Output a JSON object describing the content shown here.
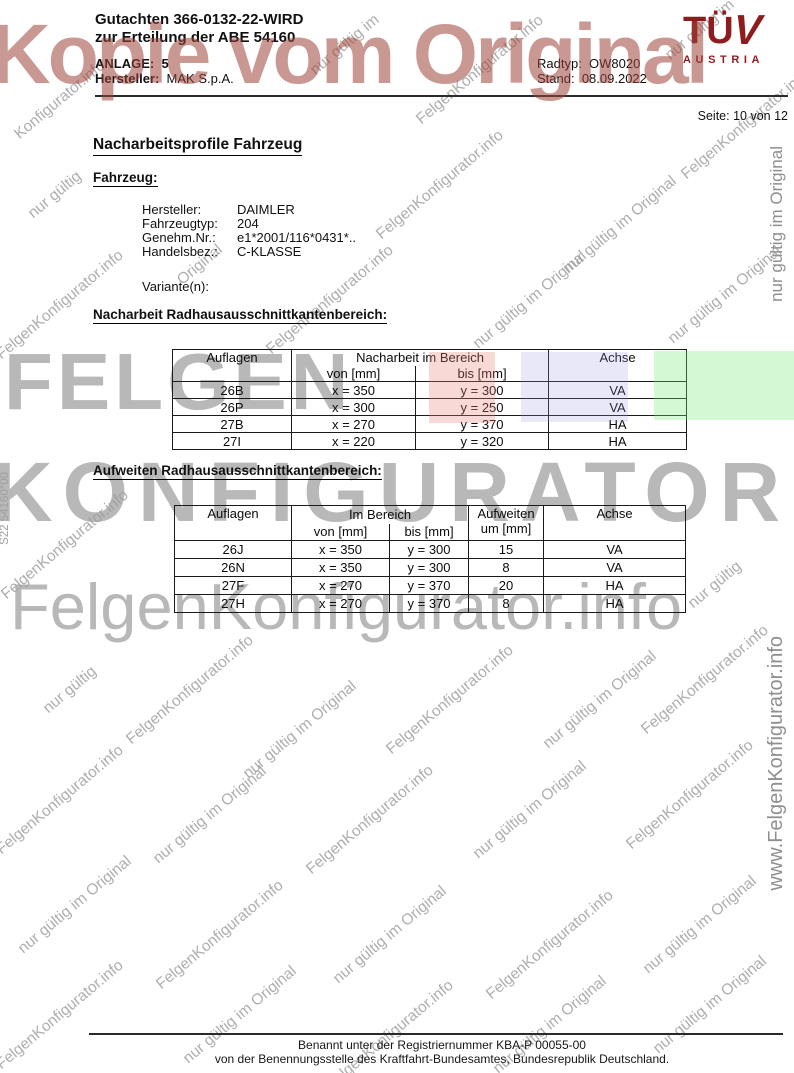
{
  "header": {
    "title_line1": "Gutachten 366-0132-22-WIRD",
    "title_line2": "zur Erteilung der ABE 54160",
    "anlage_label": "ANLAGE:",
    "anlage_value": "5",
    "hersteller_label": "Hersteller:",
    "hersteller_value": "MAK S.p.A.",
    "radtyp_label": "Radtyp:",
    "radtyp_value": "OW8020",
    "stand_label": "Stand:",
    "stand_value": "08.09.2022",
    "page_label": "Seite: 10 von 12",
    "logo": {
      "tuv_t": "T",
      "tuv_u": "Ü",
      "tuv_v": "V",
      "austria": "AUSTRIA",
      "color": "#8e1c1f"
    }
  },
  "content": {
    "main_heading": "Nacharbeitsprofile Fahrzeug",
    "vehicle_heading": "Fahrzeug:",
    "vehicle_rows": [
      {
        "label": "Hersteller:",
        "value": "DAIMLER"
      },
      {
        "label": "Fahrzeugtyp:",
        "value": "204"
      },
      {
        "label": "Genehm.Nr.:",
        "value": "e1*2001/116*0431*.."
      },
      {
        "label": "Handelsbez.:",
        "value": "C-KLASSE"
      }
    ],
    "variante_label": "Variante(n):",
    "table1": {
      "heading": "Nacharbeit Radhausausschnittkantenbereich:",
      "col_auflagen": "Auflagen",
      "col_bereich": "Nacharbeit im Bereich",
      "col_achse": "Achse",
      "sub_von": "von [mm]",
      "sub_bis": "bis [mm]",
      "rows": [
        [
          "26B",
          "x = 350",
          "y = 300",
          "VA"
        ],
        [
          "26P",
          "x = 300",
          "y = 250",
          "VA"
        ],
        [
          "27B",
          "x = 270",
          "y = 370",
          "HA"
        ],
        [
          "27I",
          "x = 220",
          "y = 320",
          "HA"
        ]
      ]
    },
    "table2": {
      "heading": "Aufweiten Radhausausschnittkantenbereich:",
      "col_auflagen": "Auflagen",
      "col_bereich": "Im Bereich",
      "col_aufweiten_l1": "Aufweiten",
      "col_aufweiten_l2": "um [mm]",
      "col_achse": "Achse",
      "sub_von": "von [mm]",
      "sub_bis": "bis [mm]",
      "rows": [
        [
          "26J",
          "x = 350",
          "y = 300",
          "15",
          "VA"
        ],
        [
          "26N",
          "x = 350",
          "y = 300",
          "8",
          "VA"
        ],
        [
          "27F",
          "x = 270",
          "y = 370",
          "20",
          "HA"
        ],
        [
          "27H",
          "x = 270",
          "y = 370",
          "8",
          "HA"
        ]
      ]
    },
    "highlights": [
      {
        "x": 429,
        "y": 352,
        "w": 66,
        "h": 71,
        "color": "rgba(236,128,118,0.30)"
      },
      {
        "x": 521,
        "y": 352,
        "w": 107,
        "h": 70,
        "color": "rgba(148,148,228,0.22)"
      },
      {
        "x": 654,
        "y": 351,
        "w": 140,
        "h": 69,
        "color": "rgba(118,232,118,0.32)"
      }
    ]
  },
  "footer": {
    "line1": "Benannt unter der Registriernummer KBA-P 00055-00",
    "line2": "von der Benennungsstelle des Kraftfahrt-Bundesamtes, Bundesrepublik Deutschland."
  },
  "watermark": {
    "kopie_text": "Kopie vom Original",
    "kopie_color": "rgba(158,68,58,0.55)",
    "big_felgen": "FELGEN",
    "big_konfigurator": "KONFIGURATOR",
    "big_info": "FelgenKonfigurator.info",
    "side_right_top": "nur gültig im Original",
    "side_right_bottom": "www.FelgenKonfigurator.info",
    "side_left": "S22 54160*00",
    "texts": [
      "nur gültig im Original",
      "FelgenKonfigurator.info",
      "Original",
      "nur gültig im",
      "Konfigurator.info",
      "nur gültig"
    ],
    "items": [
      {
        "x": 60,
        "y": 100,
        "t": 4
      },
      {
        "x": 345,
        "y": 45,
        "t": 3
      },
      {
        "x": 480,
        "y": 70,
        "t": 1
      },
      {
        "x": 700,
        "y": 30,
        "t": 3
      },
      {
        "x": 55,
        "y": 195,
        "t": 5
      },
      {
        "x": 200,
        "y": 265,
        "t": 2
      },
      {
        "x": 440,
        "y": 185,
        "t": 1
      },
      {
        "x": 620,
        "y": 225,
        "t": 0
      },
      {
        "x": 745,
        "y": 125,
        "t": 1
      },
      {
        "x": 60,
        "y": 305,
        "t": 1
      },
      {
        "x": 330,
        "y": 300,
        "t": 1
      },
      {
        "x": 530,
        "y": 300,
        "t": 0
      },
      {
        "x": 725,
        "y": 295,
        "t": 0
      },
      {
        "x": 65,
        "y": 545,
        "t": 1
      },
      {
        "x": 715,
        "y": 585,
        "t": 5
      },
      {
        "x": 70,
        "y": 690,
        "t": 5
      },
      {
        "x": 190,
        "y": 690,
        "t": 1
      },
      {
        "x": 300,
        "y": 730,
        "t": 0
      },
      {
        "x": 450,
        "y": 700,
        "t": 1
      },
      {
        "x": 600,
        "y": 700,
        "t": 0
      },
      {
        "x": 705,
        "y": 680,
        "t": 1
      },
      {
        "x": 60,
        "y": 800,
        "t": 1
      },
      {
        "x": 210,
        "y": 815,
        "t": 0
      },
      {
        "x": 370,
        "y": 820,
        "t": 1
      },
      {
        "x": 530,
        "y": 810,
        "t": 0
      },
      {
        "x": 690,
        "y": 795,
        "t": 1
      },
      {
        "x": 75,
        "y": 905,
        "t": 0
      },
      {
        "x": 220,
        "y": 935,
        "t": 1
      },
      {
        "x": 390,
        "y": 935,
        "t": 0
      },
      {
        "x": 550,
        "y": 945,
        "t": 1
      },
      {
        "x": 700,
        "y": 925,
        "t": 0
      },
      {
        "x": 60,
        "y": 1015,
        "t": 1
      },
      {
        "x": 240,
        "y": 1015,
        "t": 0
      },
      {
        "x": 390,
        "y": 1035,
        "t": 1
      },
      {
        "x": 550,
        "y": 1025,
        "t": 0
      },
      {
        "x": 710,
        "y": 1005,
        "t": 0
      }
    ]
  }
}
